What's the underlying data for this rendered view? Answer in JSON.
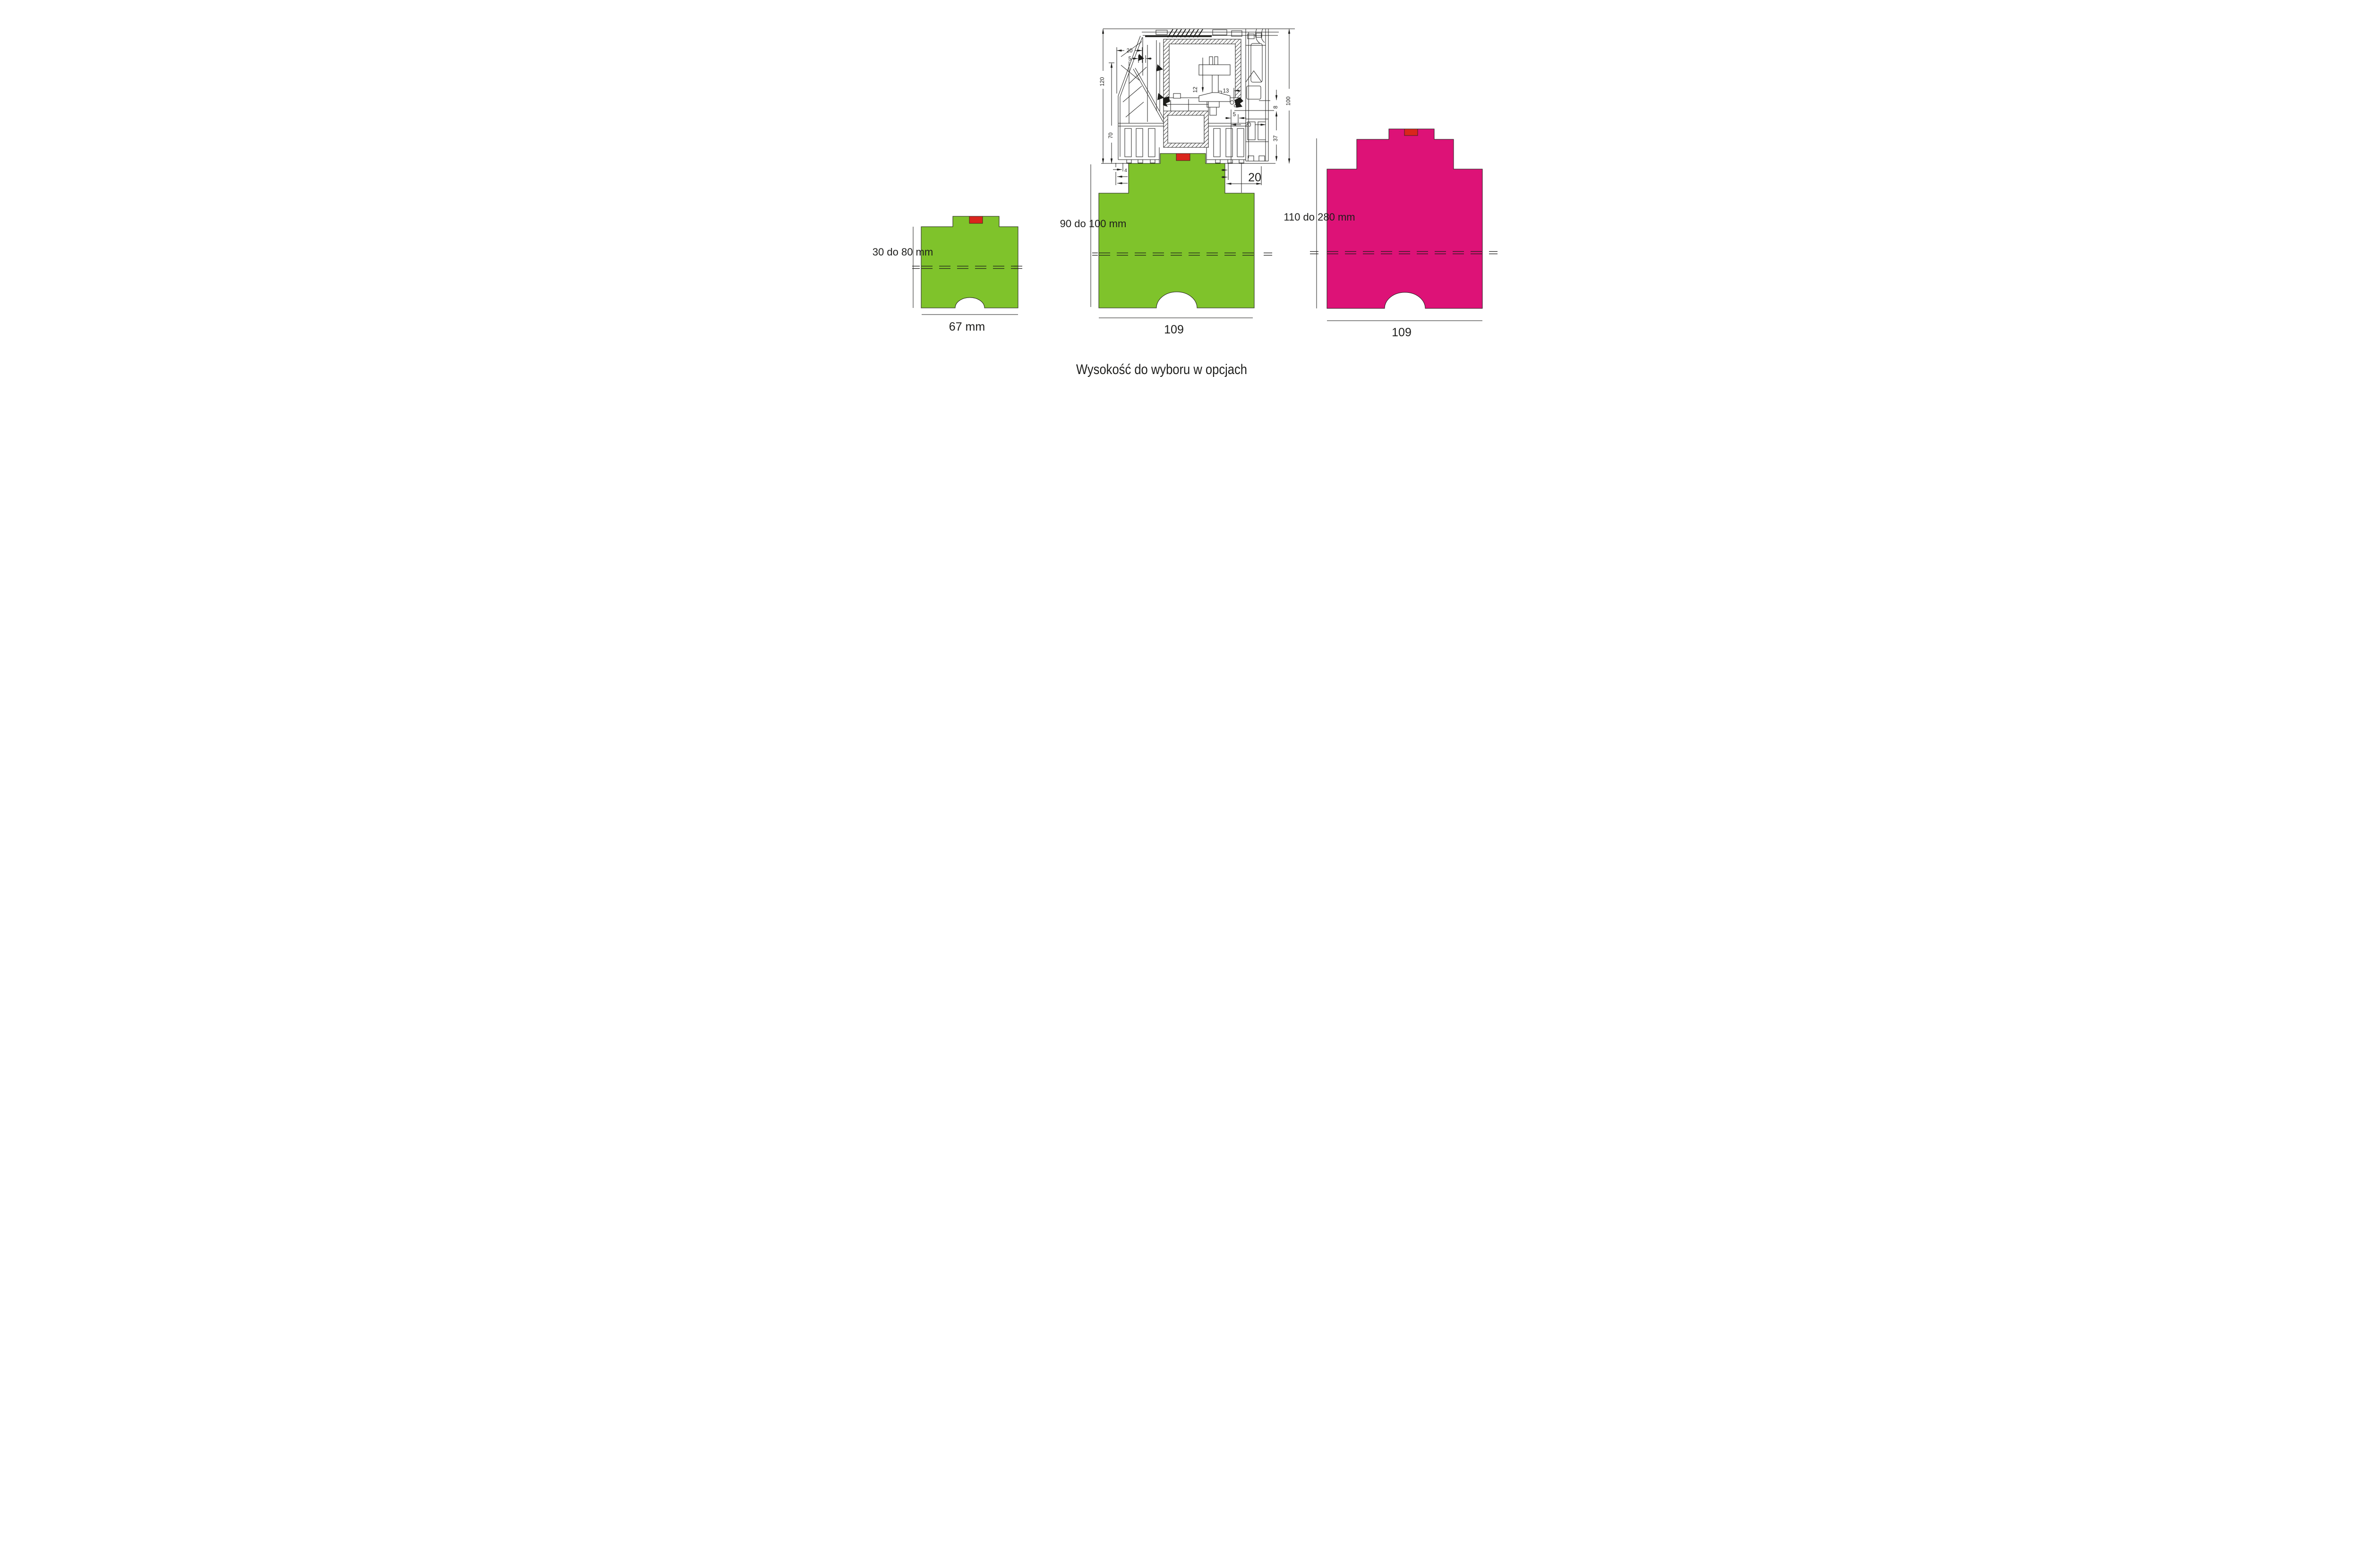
{
  "colors": {
    "green": "#7fc32b",
    "magenta": "#dd1277",
    "red": "#d9261c",
    "ink": "#1d1d1b"
  },
  "caption": {
    "text": "Wysokość do wyboru w opcjach"
  },
  "drawing": {
    "label": "window-sill-profile-cross-section",
    "dims": {
      "outer_height": "120",
      "inner_height": "70",
      "top_width": "20",
      "top_gap": "5",
      "mid_left": "12",
      "mid_right": "13",
      "right_height": "100",
      "right_step": "8",
      "right_base": "37",
      "base_gap": "5",
      "base_width": "20"
    }
  },
  "profiles": {
    "small": {
      "height_range": "30 do 80 mm",
      "width": "67 mm"
    },
    "medium": {
      "height_range": "90 do 100 mm",
      "width": "109",
      "step": "4",
      "top_width": "20"
    },
    "large": {
      "height_range": "110 do 280 mm",
      "width": "109"
    }
  }
}
